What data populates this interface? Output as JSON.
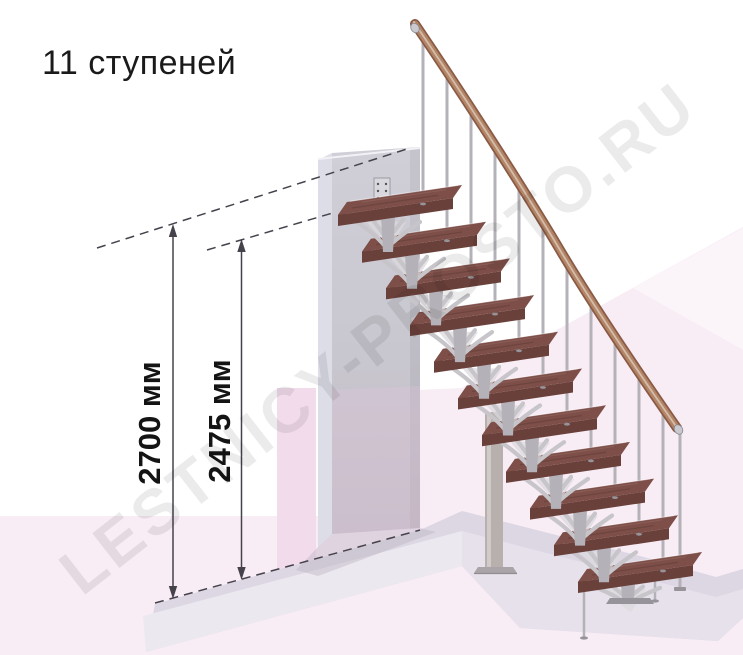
{
  "title": "11 ступеней",
  "watermark": "LESTNICY-PROSTO.RU",
  "stairs": {
    "steps_count": 11,
    "steps_unit_label": "ступеней"
  },
  "dimensions": [
    {
      "id": "total-height",
      "label": "2700 мм",
      "value_mm": 2700
    },
    {
      "id": "height-to-top-step",
      "label": "2475 мм",
      "value_mm": 2475
    }
  ],
  "colors": {
    "tread_top": "#7e4f48",
    "tread_front": "#6a403b",
    "tread_side": "#5c3733",
    "rail": "#b28566",
    "rail_dark": "#8a5a45",
    "metal": "#b4b2b8",
    "metal_dark": "#96949a",
    "bracket": "#c7c5c9",
    "bracket_web": "#dcdade",
    "column": "#b7b0ac",
    "wall": "#c8c6ce",
    "wall_side": "#dcdde7",
    "floor_pink": "#f8ecf5",
    "floor_pink_dark": "#f2dcec",
    "slab_top": "#dcd7e3",
    "slab_front_left": "#ece8f0",
    "slab_front_right": "#e6e1eb",
    "dimension_line": "#46424c",
    "text": "#1a1a1a"
  }
}
